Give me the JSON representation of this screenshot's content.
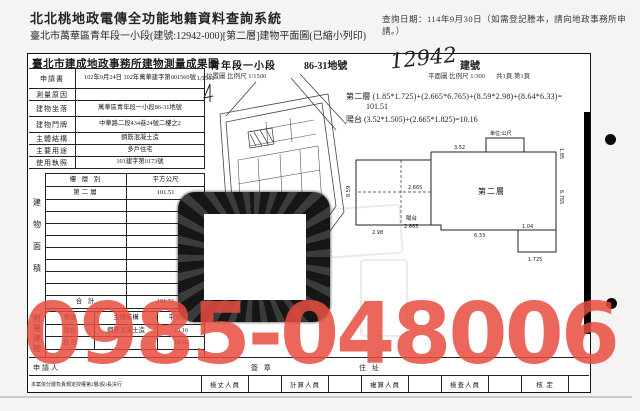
{
  "system_header": {
    "title": "北北桃地政電傳全功能地籍資料查詢系統",
    "query_date_note": "查詢日期：114年9月30日（如需登記謄本，請向地政事務所申請。）",
    "subtitle": "臺北市萬華區青年段一小段(建號:12942-000)[第二層]建物平面圖(已縮小列印)"
  },
  "red_watermark": {
    "phone": "0985-048006",
    "color": "#e84c40"
  },
  "document": {
    "title": "臺北市建成地政事務所建物測量成果圖",
    "section_name": "青年段一小段",
    "parcel_no": "86-31地號",
    "building_no_handwritten": "12942",
    "building_no_label": "建號",
    "location_map_scale": "位置圖 比例尺 1/1500",
    "location_map_scale_small": "1/1500",
    "plan_scale": "平面圖 比例尺 1/300",
    "page_info": "共1頁 第1頁",
    "info_rows": [
      {
        "label": "申請書",
        "value": "102年9月24日 102年萬華建字第001560號"
      },
      {
        "label": "測量原因",
        "value": ""
      },
      {
        "label": "建物坐落",
        "value": "萬華區青年段一小段86-31地號"
      },
      {
        "label": "建物門牌",
        "value": "中華路二段434巷24號二樓之2"
      },
      {
        "label": "主體結構",
        "value": "鋼筋混凝土造"
      },
      {
        "label": "主要用途",
        "value": "多戶住宅"
      },
      {
        "label": "使用執照",
        "value": "101建字第0173號"
      }
    ],
    "area_table": {
      "side_label": "建物面積",
      "col_floor": "樓 層 別",
      "col_area": "平方公尺",
      "rows": [
        {
          "floor": "第二層",
          "area": "101.51"
        }
      ],
      "total_label": "合  計",
      "total": "101.51"
    },
    "annex_table": {
      "side_label": "附屬建物",
      "col_use": "用途",
      "col_material": "主體結構",
      "col_area": "平方公尺",
      "rows": [
        {
          "use": "陽台",
          "material": "鋼筋混凝土造",
          "area": "10.16"
        }
      ],
      "total_label": "合 計",
      "total": "10.16"
    },
    "formulas": {
      "line1": "第二層 (1.85*1.725)+(2.665*6.765)+(8.59*2.98)+(8.64*6.33)=",
      "line2": "101.51",
      "line3": "陽台 (3.52*1.505)+(2.665*1.825)=10.16"
    },
    "plan": {
      "unit": "單位:公尺",
      "room_label": "第二層",
      "balcony_label": "陽台",
      "dims": {
        "left_h": "8.59",
        "bottom_left": "2.98",
        "mid_w": "2.665",
        "balcony_w": "2.665",
        "bottom_right": "6.33",
        "step_w": "1.725",
        "top_right": "1.85",
        "right_h": "6.765",
        "small_h": "1.04",
        "top_w": "3.52"
      }
    },
    "footer": {
      "applicant_label": "申請人",
      "sign_label": "簽 章",
      "address_label": "住 址",
      "delegation_note": "本案依分層負責規定授權第2層(股)長決行",
      "staff_labels": [
        "檢丈人員",
        "計算人員",
        "複算人員",
        "檢查人員",
        "核 定"
      ]
    }
  }
}
